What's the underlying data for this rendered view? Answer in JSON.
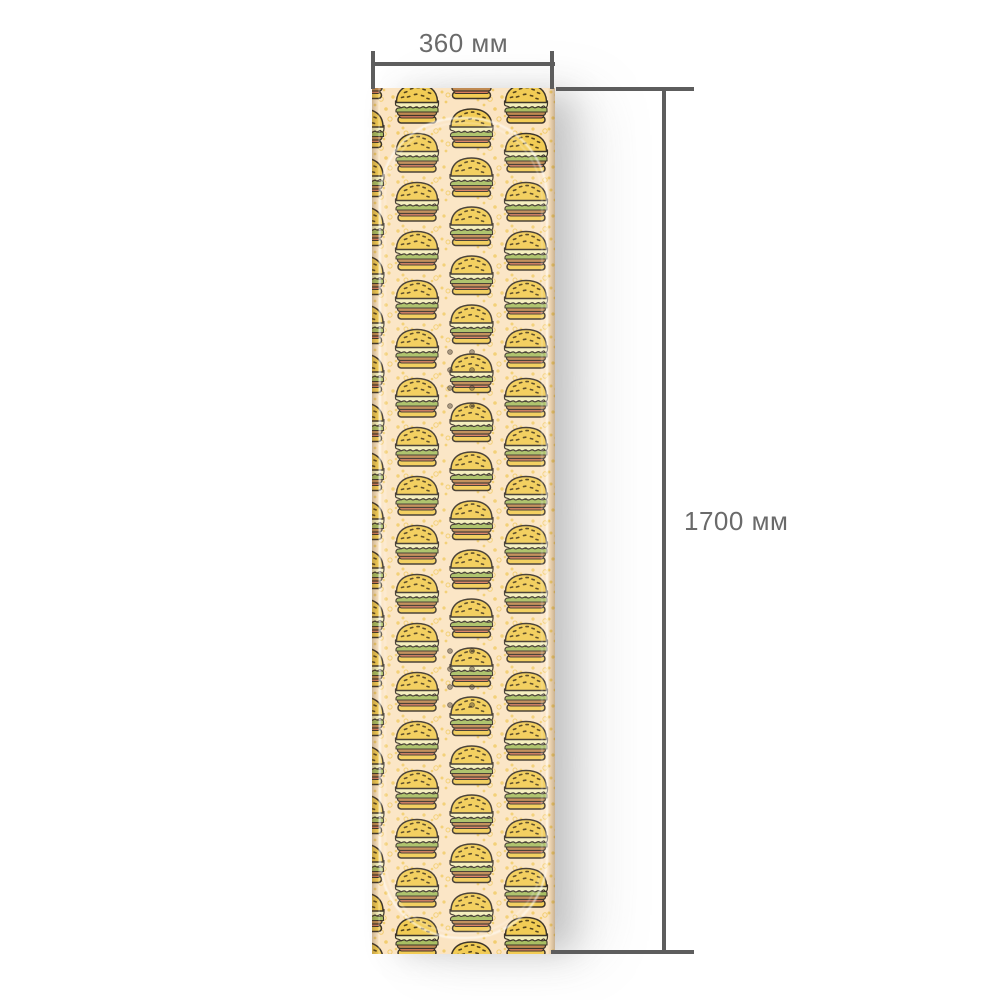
{
  "diagram": {
    "subject": "patterned wrap sheet with dimension callouts",
    "width_dimension": {
      "label": "360 мм",
      "value_mm": 360
    },
    "height_dimension": {
      "label": "1700 мм",
      "value_mm": 1700
    }
  },
  "pattern": {
    "motif": "cheeseburger-icon",
    "background": "cream with scattered yellow speckle dots",
    "overlay": "glossy board outline with two groups of insert holes"
  },
  "colors": {
    "page-bg": "#ffffff",
    "dim-line": "#5d5d5d",
    "dim-text": "#6a6a6a",
    "sheet-bg": "#fbe4c2",
    "dot": "#f2cd6e",
    "outline": "#3d352a",
    "bun": "#f2cc55",
    "cheese": "#f4eeba",
    "lettuce": "#a9bf63",
    "patty": "#c08a52",
    "tomato": "#d97d5d",
    "seed": "#54431c"
  }
}
